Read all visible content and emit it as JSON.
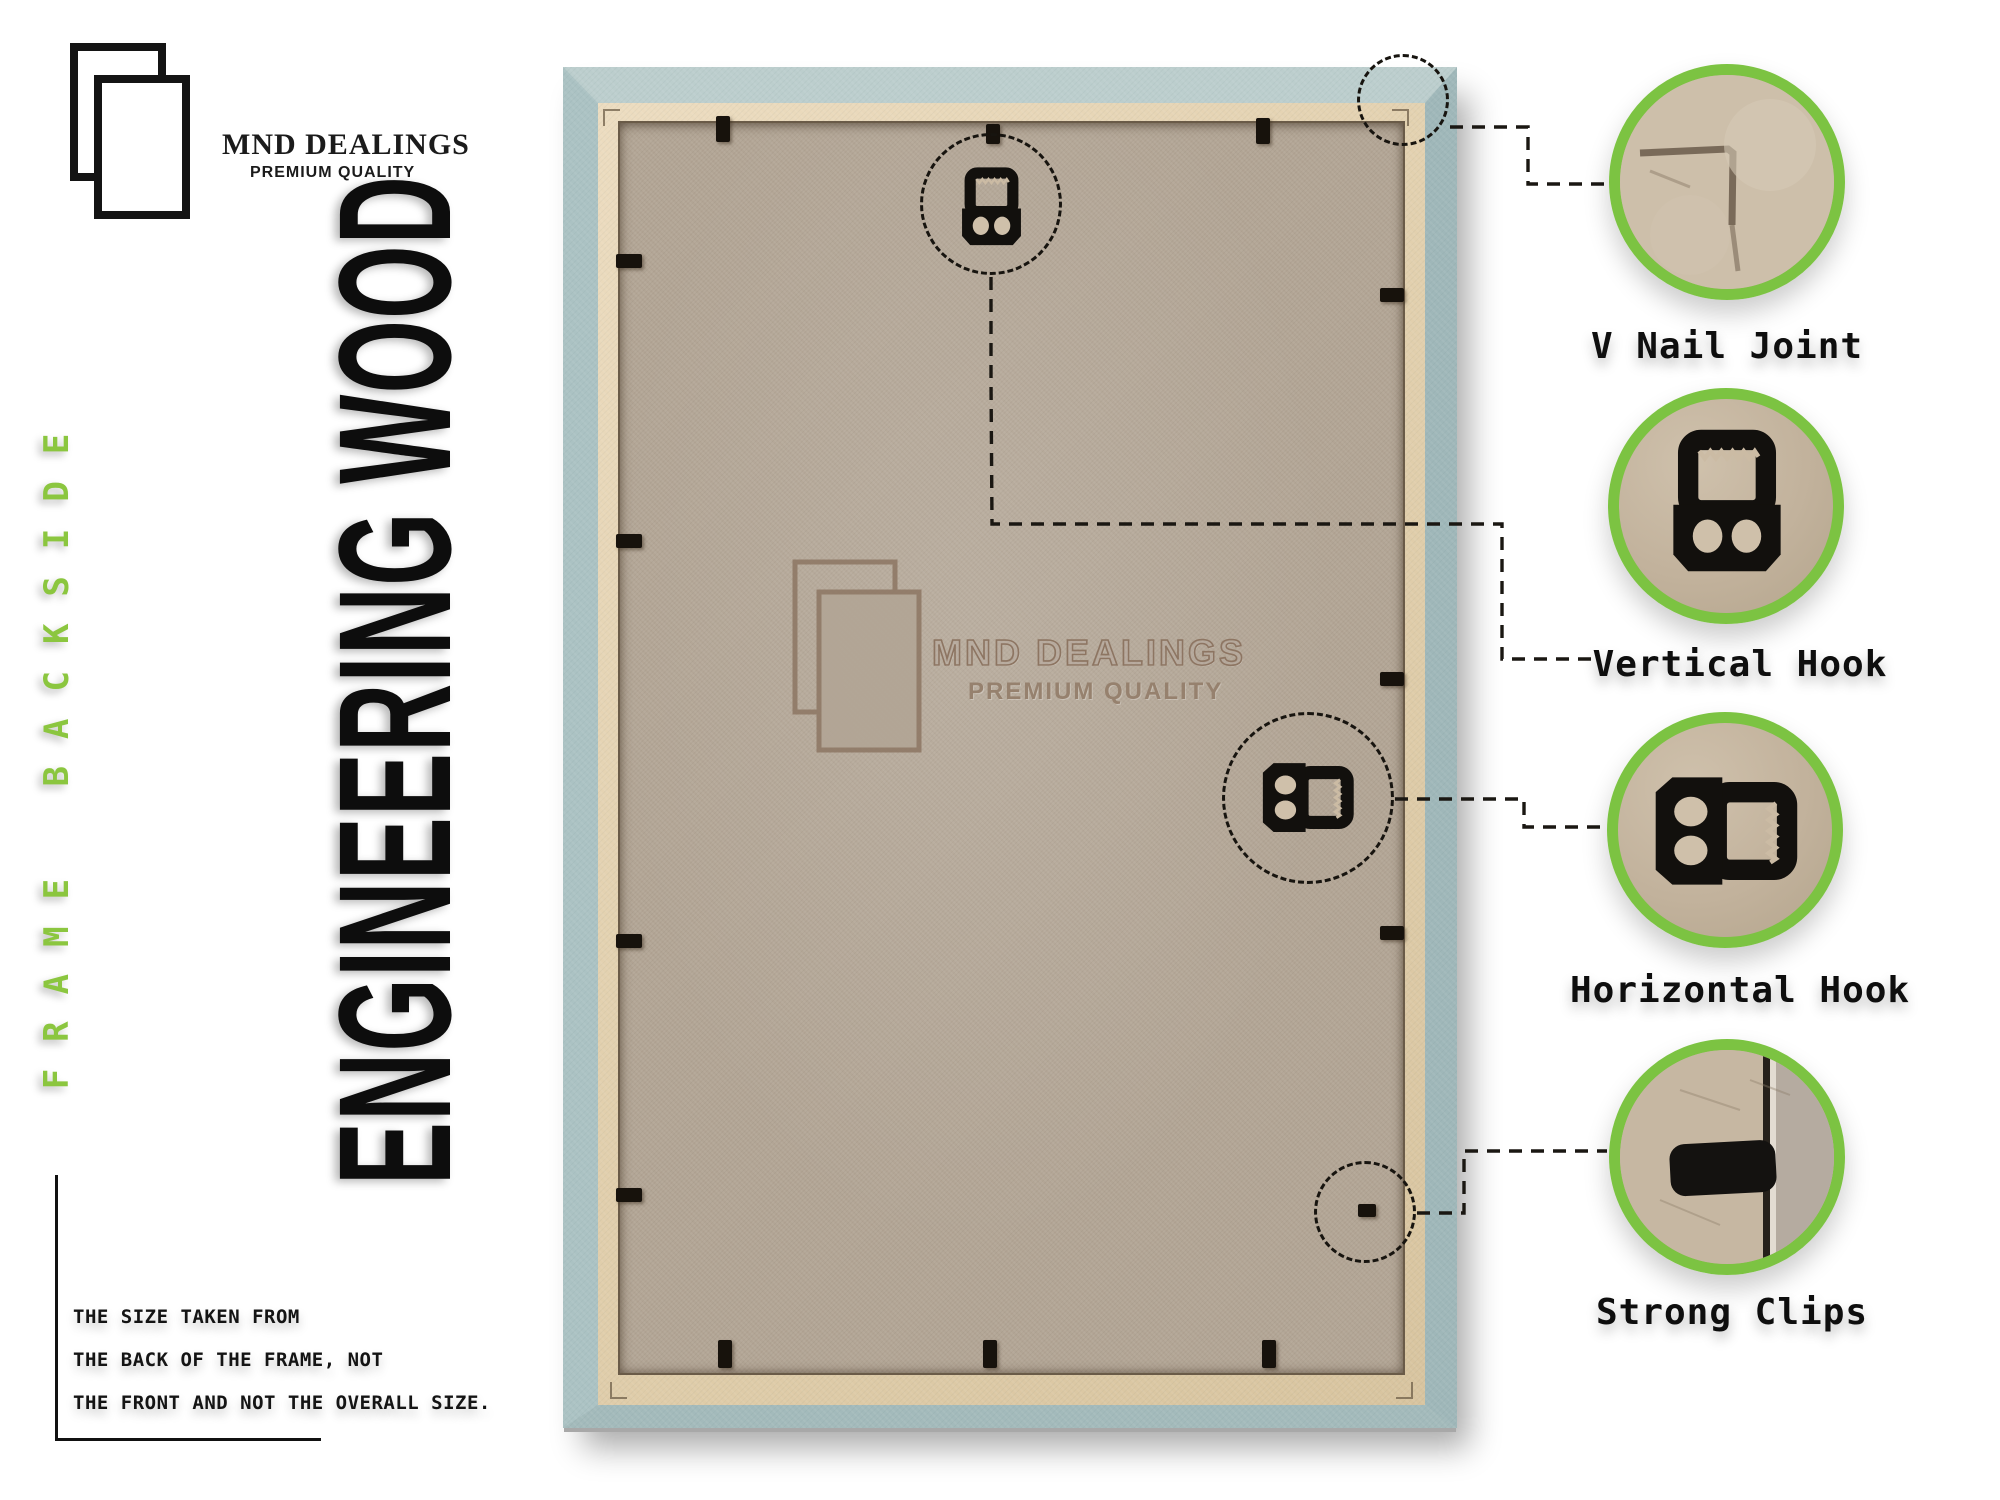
{
  "brand": {
    "name": "MND DEALINGS",
    "tagline": "PREMIUM QUALITY"
  },
  "side_label": "FRAME BACKSIDE",
  "material_title": "ENGINEERING WOOD",
  "note": {
    "lines": [
      "THE SIZE TAKEN FROM",
      "THE BACK OF THE FRAME, NOT",
      "THE FRONT AND NOT THE OVERALL SIZE."
    ]
  },
  "callouts": [
    {
      "label": "V Nail Joint",
      "icon": "miter-joint-photo"
    },
    {
      "label": "Vertical Hook",
      "icon": "sawtooth-hanger-vertical"
    },
    {
      "label": "Horizontal Hook",
      "icon": "sawtooth-hanger-horizontal"
    },
    {
      "label": "Strong Clips",
      "icon": "back-panel-clip"
    }
  ],
  "colors": {
    "accent_green": "#7cc342",
    "frame_teal": "#a9c0c1",
    "frame_wood_tan": "#e2d0b0",
    "backboard_mdf": "#b2a595",
    "hardware_black": "#15120e"
  }
}
